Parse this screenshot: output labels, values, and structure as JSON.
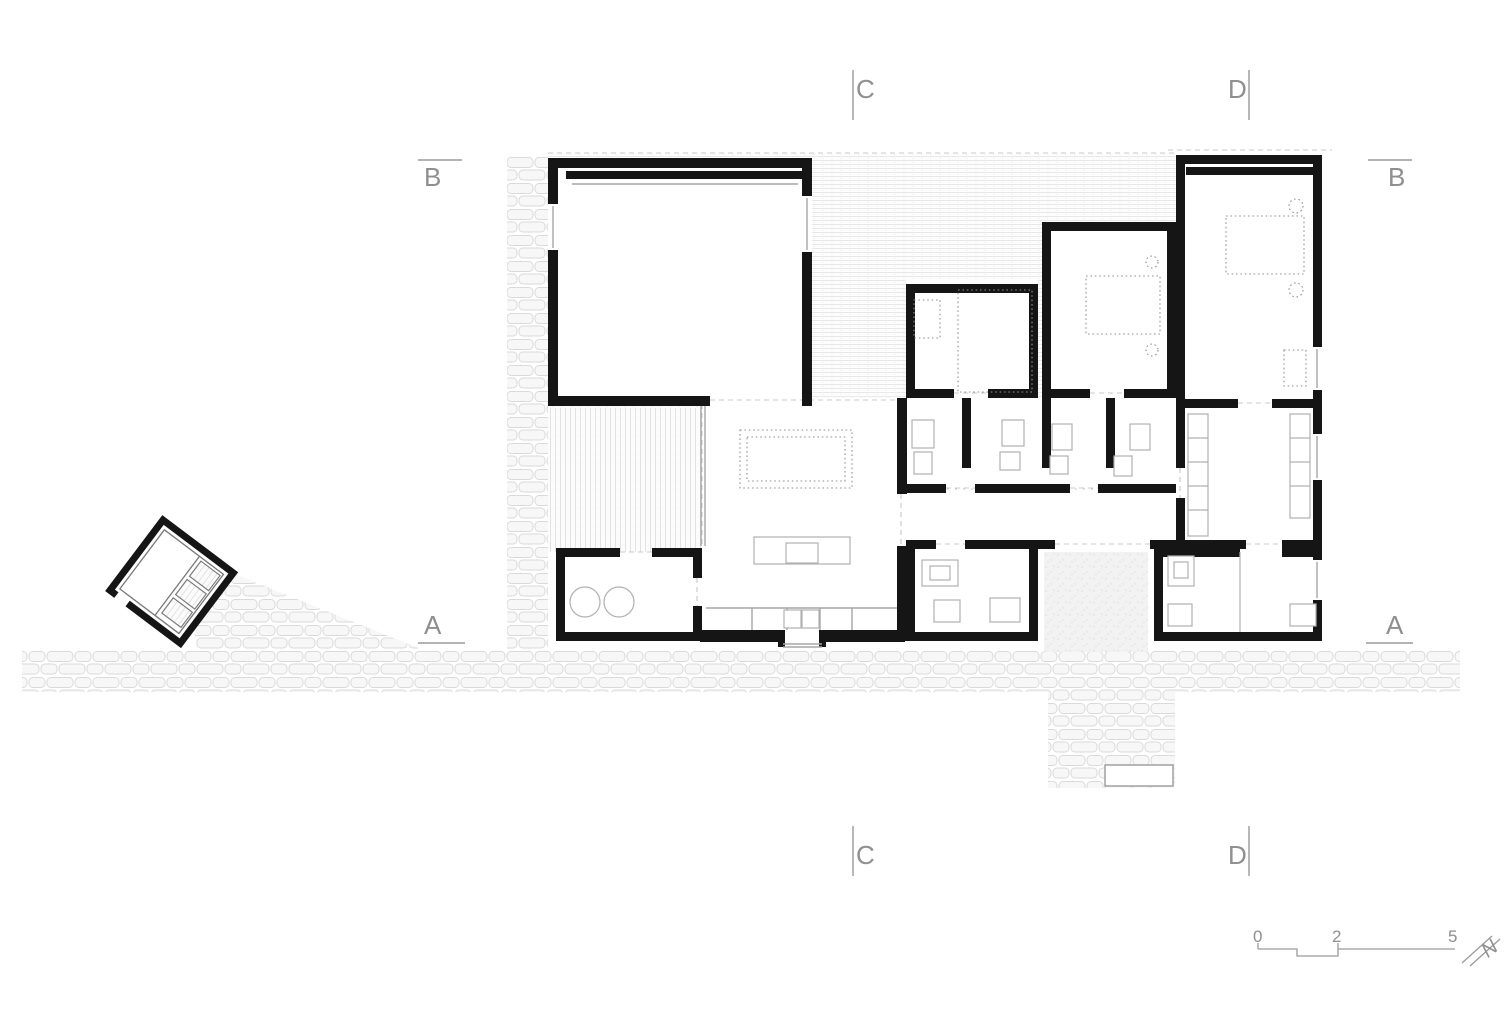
{
  "drawing": {
    "section_markers": {
      "c_top": "C",
      "d_top": "D",
      "b_left": "B",
      "b_right": "B",
      "a_left": "A",
      "a_right": "A",
      "c_bottom": "C",
      "d_bottom": "D"
    },
    "scale_bar": {
      "tick_0": "0",
      "tick_2": "2",
      "tick_5": "5"
    },
    "north_label": "N",
    "colors": {
      "walls": "#151515",
      "marker_text": "#8f8f8f",
      "stone_outline": "#d9d9d9",
      "furniture_gray": "#b0b0b0",
      "dashed_ref": "#c8c8c8"
    }
  }
}
